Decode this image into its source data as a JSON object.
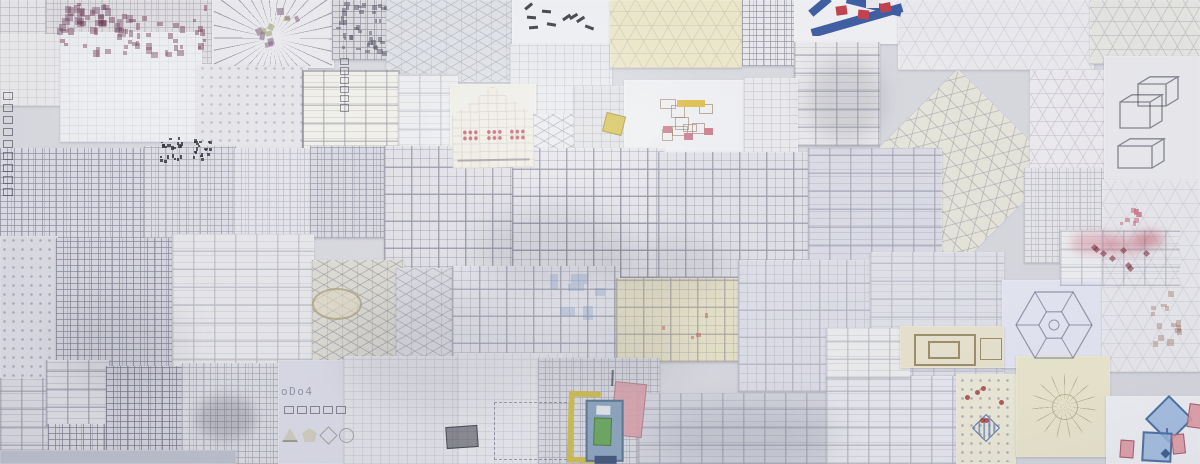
{
  "scene": {
    "name": "wall-of-architectural-pattern-drawings",
    "width": 1200,
    "height": 464
  },
  "text": {
    "odo": "oDo4"
  },
  "palette": {
    "paper_white": "#eff0f3",
    "paper_lavender": "#d8d9e4",
    "paper_cream": "#ece7c6",
    "pencil": "#55556a",
    "model_blue": "#31519c",
    "model_red": "#bf3540",
    "accent_pink": "#c97486",
    "accent_yellow": "#d4bf4a",
    "accent_green": "#69a55e",
    "accent_blue": "#8aa3bd"
  },
  "sheets": [
    {
      "x": 0,
      "y": 0,
      "w": 48,
      "h": 96,
      "bg": "#e7e6e8",
      "p": "grid",
      "po": 0.35
    },
    {
      "x": 46,
      "y": 0,
      "w": 168,
      "h": 70,
      "bg": "#e0dee1",
      "p": "maze",
      "po": 0.3
    },
    {
      "x": 212,
      "y": 0,
      "w": 122,
      "h": 68,
      "bg": "#ebeaee",
      "p": "blank",
      "po": 0
    },
    {
      "x": 332,
      "y": 0,
      "w": 58,
      "h": 60,
      "bg": "#dbdade",
      "p": "maze",
      "po": 0.55
    },
    {
      "x": 386,
      "y": 0,
      "w": 128,
      "h": 82,
      "bg": "#dde0e4",
      "p": "iso",
      "po": 0.35
    },
    {
      "x": 512,
      "y": 0,
      "w": 98,
      "h": 46,
      "bg": "#eef0f4",
      "p": "blank",
      "po": 0
    },
    {
      "x": 510,
      "y": 44,
      "w": 102,
      "h": 74,
      "bg": "#e8eaee",
      "p": "grid",
      "po": 0.22
    },
    {
      "x": 610,
      "y": 0,
      "w": 132,
      "h": 68,
      "bg": "#ece7c6",
      "p": "hex",
      "po": 0.25
    },
    {
      "x": 742,
      "y": 0,
      "w": 54,
      "h": 66,
      "bg": "#e9e8ec",
      "p": "maze",
      "po": 0.6
    },
    {
      "x": 794,
      "y": 0,
      "w": 124,
      "h": 44,
      "bg": "#f0f1f4",
      "p": "blank",
      "po": 0
    },
    {
      "x": 794,
      "y": 42,
      "w": 86,
      "h": 104,
      "bg": "#eaeaed",
      "p": "rooms",
      "po": 0.5
    },
    {
      "x": 898,
      "y": 0,
      "w": 196,
      "h": 70,
      "bg": "#ebebef",
      "p": "hex",
      "po": 0.22
    },
    {
      "x": 1090,
      "y": 0,
      "w": 110,
      "h": 64,
      "bg": "#e7e7e3",
      "p": "hex",
      "po": 0.35
    },
    {
      "x": 0,
      "y": 34,
      "w": 62,
      "h": 72,
      "bg": "#eae9eb",
      "p": "grid",
      "po": 0.2
    },
    {
      "x": 60,
      "y": 32,
      "w": 142,
      "h": 110,
      "bg": "#edeff2",
      "p": "grid",
      "po": 0.15
    },
    {
      "x": 198,
      "y": 64,
      "w": 110,
      "h": 100,
      "bg": "#e6e5e9",
      "p": "dots",
      "po": 0.4
    },
    {
      "x": 302,
      "y": 70,
      "w": 98,
      "h": 90,
      "bg": "#f1f0ea",
      "p": "rooms",
      "po": 0.5,
      "bd": 1
    },
    {
      "x": 398,
      "y": 74,
      "w": 60,
      "h": 92,
      "bg": "#ebedf0",
      "p": "rooms",
      "po": 0.3
    },
    {
      "x": 450,
      "y": 84,
      "w": 86,
      "h": 84,
      "bg": "#eeede6",
      "p": "blank",
      "po": 0
    },
    {
      "x": 518,
      "y": 114,
      "w": 66,
      "h": 54,
      "bg": "#e9eaed",
      "p": "iso",
      "po": 0.5
    },
    {
      "x": 574,
      "y": 86,
      "w": 54,
      "h": 80,
      "bg": "#e0e2e5",
      "p": "grid",
      "po": 0.3
    },
    {
      "x": 624,
      "y": 80,
      "w": 124,
      "h": 82,
      "bg": "#eeeff2",
      "p": "blank",
      "po": 0
    },
    {
      "x": 744,
      "y": 78,
      "w": 54,
      "h": 86,
      "bg": "#e9e9ec",
      "p": "grid",
      "po": 0.25
    },
    {
      "x": 888,
      "y": 98,
      "w": 140,
      "h": 140,
      "bg": "#e6e5da",
      "p": "hex",
      "po": 0.5,
      "rot": 45
    },
    {
      "x": 1030,
      "y": 70,
      "w": 90,
      "h": 108,
      "bg": "#edebef",
      "p": "hex",
      "po": 0.3
    },
    {
      "x": 1024,
      "y": 168,
      "w": 84,
      "h": 95,
      "bg": "#e6e6ea",
      "p": "maze",
      "po": 0.3
    },
    {
      "x": 1104,
      "y": 56,
      "w": 96,
      "h": 126,
      "bg": "#eaeaee",
      "p": "blank",
      "po": 0
    },
    {
      "x": 0,
      "y": 148,
      "w": 146,
      "h": 90,
      "bg": "#dadae4",
      "p": "maze",
      "po": 0.6
    },
    {
      "x": 144,
      "y": 146,
      "w": 92,
      "h": 92,
      "bg": "#dedee6",
      "p": "maze",
      "po": 0.45
    },
    {
      "x": 234,
      "y": 148,
      "w": 78,
      "h": 90,
      "bg": "#e4e4ea",
      "p": "maze",
      "po": 0.3
    },
    {
      "x": 310,
      "y": 146,
      "w": 92,
      "h": 92,
      "bg": "#d8d8e2",
      "p": "maze",
      "po": 0.5
    },
    {
      "x": 384,
      "y": 146,
      "w": 134,
      "h": 130,
      "bg": "#e0e0e6",
      "p": "tiles",
      "po": 0.55
    },
    {
      "x": 512,
      "y": 148,
      "w": 152,
      "h": 130,
      "bg": "#e4e4ea",
      "p": "tiles",
      "po": 0.6
    },
    {
      "x": 658,
      "y": 152,
      "w": 154,
      "h": 126,
      "bg": "#dfdfe7",
      "p": "tiles",
      "po": 0.5
    },
    {
      "x": 808,
      "y": 148,
      "w": 134,
      "h": 134,
      "bg": "#d9dae5",
      "p": "rooms",
      "po": 0.45
    },
    {
      "x": 1060,
      "y": 230,
      "w": 122,
      "h": 58,
      "bg": "#eff0f2",
      "p": "blank",
      "po": 0
    },
    {
      "x": 1158,
      "y": 182,
      "w": 42,
      "h": 130,
      "bg": "#e6e6eb",
      "p": "grid",
      "po": 0.3
    },
    {
      "x": 0,
      "y": 236,
      "w": 58,
      "h": 148,
      "bg": "#dadae3",
      "p": "dots",
      "po": 0.5
    },
    {
      "x": 56,
      "y": 238,
      "w": 120,
      "h": 154,
      "bg": "#d5d6df",
      "p": "maze",
      "po": 0.65
    },
    {
      "x": 172,
      "y": 234,
      "w": 142,
      "h": 162,
      "bg": "#e7e7eb",
      "p": "rooms",
      "po": 0.35
    },
    {
      "x": 312,
      "y": 260,
      "w": 92,
      "h": 112,
      "bg": "#dcdad2",
      "p": "iso",
      "po": 0.5
    },
    {
      "x": 396,
      "y": 268,
      "w": 100,
      "h": 104,
      "bg": "#dbdce1",
      "p": "iso",
      "po": 0.45
    },
    {
      "x": 452,
      "y": 266,
      "w": 168,
      "h": 132,
      "bg": "#e3e4eb",
      "p": "tiles",
      "po": 0.45
    },
    {
      "x": 616,
      "y": 278,
      "w": 124,
      "h": 84,
      "bg": "#e5e1c6",
      "p": "tiles",
      "po": 0.4
    },
    {
      "x": 738,
      "y": 260,
      "w": 138,
      "h": 132,
      "bg": "#dddee7",
      "p": "tiles",
      "po": 0.3
    },
    {
      "x": 870,
      "y": 252,
      "w": 134,
      "h": 138,
      "bg": "#e0e1e9",
      "p": "rooms",
      "po": 0.3
    },
    {
      "x": 1002,
      "y": 280,
      "w": 104,
      "h": 88,
      "bg": "#e4e6f3",
      "p": "blank",
      "po": 0
    },
    {
      "x": 1102,
      "y": 180,
      "w": 98,
      "h": 192,
      "bg": "#e9e9ed",
      "p": "hex",
      "po": 0.2
    },
    {
      "x": 0,
      "y": 378,
      "w": 54,
      "h": 86,
      "bg": "#d9d9e1",
      "p": "rooms",
      "po": 0.5
    },
    {
      "x": 46,
      "y": 360,
      "w": 64,
      "h": 66,
      "bg": "#dddde3",
      "p": "rooms",
      "po": 0.55
    },
    {
      "x": 48,
      "y": 424,
      "w": 64,
      "h": 40,
      "bg": "#d7d7df",
      "p": "maze",
      "po": 0.7
    },
    {
      "x": 106,
      "y": 366,
      "w": 80,
      "h": 98,
      "bg": "#d0d1db",
      "p": "maze",
      "po": 0.75
    },
    {
      "x": 182,
      "y": 363,
      "w": 102,
      "h": 101,
      "bg": "#dbdce3",
      "p": "maze",
      "po": 0.4
    },
    {
      "x": 278,
      "y": 360,
      "w": 70,
      "h": 104,
      "bg": "#d9dae5",
      "p": "blank",
      "po": 0
    },
    {
      "x": 344,
      "y": 356,
      "w": 120,
      "h": 108,
      "bg": "#e1e2e7",
      "p": "grid",
      "po": 0.2
    },
    {
      "x": 458,
      "y": 353,
      "w": 114,
      "h": 111,
      "bg": "#e6e7eb",
      "p": "grid",
      "po": 0.18
    },
    {
      "x": 538,
      "y": 358,
      "w": 122,
      "h": 106,
      "bg": "#d9d9e1",
      "p": "maze",
      "po": 0.35
    },
    {
      "x": 638,
      "y": 393,
      "w": 194,
      "h": 71,
      "bg": "#d4d5de",
      "p": "rooms",
      "po": 0.4
    },
    {
      "x": 826,
      "y": 376,
      "w": 136,
      "h": 88,
      "bg": "#e8e9ef",
      "p": "rooms",
      "po": 0.4
    },
    {
      "x": 826,
      "y": 328,
      "w": 84,
      "h": 50,
      "bg": "#edeeee",
      "p": "rooms",
      "po": 0.35
    },
    {
      "x": 900,
      "y": 326,
      "w": 104,
      "h": 42,
      "bg": "#e9e3cd",
      "p": "blank",
      "po": 0
    },
    {
      "x": 956,
      "y": 374,
      "w": 60,
      "h": 90,
      "bg": "#edead8",
      "p": "blank",
      "po": 0
    },
    {
      "x": 1016,
      "y": 356,
      "w": 94,
      "h": 101,
      "bg": "#ebe7cd",
      "p": "blank",
      "po": 0
    },
    {
      "x": 1106,
      "y": 396,
      "w": 94,
      "h": 68,
      "bg": "#eff1f5",
      "p": "blank",
      "po": 0
    },
    {
      "x": 0,
      "y": 450,
      "w": 236,
      "h": 14,
      "bg": "#bcbfcb",
      "p": "blank",
      "po": 0
    }
  ],
  "accents": [
    {
      "t": "cluster",
      "x": 50,
      "y": 2,
      "w": 160,
      "h": 56,
      "n": 55,
      "s": 5,
      "c": "rgba(112,52,76,0.5)",
      "seed": 7
    },
    {
      "t": "cluster",
      "x": 56,
      "y": 4,
      "w": 78,
      "h": 34,
      "n": 25,
      "s": 7,
      "c": "rgba(96,42,72,0.4)",
      "seed": 11
    },
    {
      "t": "cluster",
      "x": 336,
      "y": 2,
      "w": 52,
      "h": 54,
      "n": 40,
      "s": 4,
      "c": "rgba(66,66,82,0.5)",
      "seed": 3
    },
    {
      "t": "burst",
      "x": 214,
      "y": 0,
      "w": 118,
      "h": 66,
      "c": "rgba(72,72,88,0.5)",
      "bg": "#ecebef"
    },
    {
      "t": "cluster",
      "x": 246,
      "y": 8,
      "w": 54,
      "h": 40,
      "n": 7,
      "s": 6,
      "c": "rgba(118,88,118,0.55)",
      "seed": 5,
      "rot": 30
    },
    {
      "t": "cluster",
      "x": 258,
      "y": 14,
      "w": 34,
      "h": 24,
      "n": 4,
      "s": 5,
      "c": "rgba(148,148,88,0.55)",
      "seed": 9,
      "rot": 30
    },
    {
      "t": "cluster",
      "x": 520,
      "y": 4,
      "w": 84,
      "h": 36,
      "n": 9,
      "s": 9,
      "c": "rgba(25,25,32,0.85)",
      "seed": 13,
      "rot": 40,
      "bar": 2.5
    },
    {
      "t": "model",
      "x": 806,
      "y": 0,
      "w": 110,
      "h": 36,
      "blue": "#31519c",
      "red": "#bf3540",
      "white": "#e9eaee"
    },
    {
      "t": "blob",
      "x": 806,
      "y": 58,
      "w": 78,
      "h": 84,
      "c": "rgba(58,58,76,0.16)",
      "blur": 10
    },
    {
      "t": "house",
      "x": 452,
      "y": 86,
      "w": 82,
      "h": 82,
      "bg": "#efece2",
      "dot": "#c25668",
      "line": "rgba(90,90,108,0.5)"
    },
    {
      "t": "rect",
      "x": 604,
      "y": 114,
      "w": 18,
      "h": 18,
      "c": "#d4bf4a",
      "bd": "rgba(120,100,40,0.5)",
      "rot": 14
    },
    {
      "t": "pav",
      "x": 650,
      "y": 90,
      "w": 84,
      "h": 62,
      "ink": "rgba(135,95,70,0.55)",
      "bar": "#dcb93e",
      "pk": "#c97486",
      "seed": 17
    },
    {
      "t": "cluster",
      "x": 158,
      "y": 136,
      "w": 26,
      "h": 28,
      "n": 22,
      "s": 3,
      "c": "rgba(25,25,35,0.8)",
      "seed": 21
    },
    {
      "t": "cluster",
      "x": 192,
      "y": 138,
      "w": 22,
      "h": 26,
      "n": 18,
      "s": 3,
      "c": "rgba(25,25,35,0.75)",
      "seed": 22
    },
    {
      "t": "strip",
      "x": 3,
      "y": 92,
      "n": 9,
      "s": 8,
      "gap": 6,
      "dir": "v",
      "c": "rgba(40,40,58,0.55)"
    },
    {
      "t": "strip",
      "x": 340,
      "y": 58,
      "n": 6,
      "s": 7,
      "gap": 4,
      "dir": "v",
      "c": "rgba(40,40,58,0.5)"
    },
    {
      "t": "strip",
      "x": 284,
      "y": 406,
      "n": 5,
      "s": 8,
      "gap": 5,
      "dir": "h",
      "c": "rgba(40,40,58,0.5)"
    },
    {
      "t": "text",
      "x": 281,
      "y": 385,
      "bind": "text.odo",
      "c": "rgba(70,70,100,0.55)"
    },
    {
      "t": "shapesrow",
      "x": 282,
      "y": 424,
      "c": "rgba(205,202,186,0.95)",
      "bd": "rgba(120,120,110,0.6)"
    },
    {
      "t": "ell",
      "x": 312,
      "y": 288,
      "w": 46,
      "h": 28,
      "c": "rgba(150,140,105,0.6)",
      "bg": "rgba(226,218,192,0.55)"
    },
    {
      "t": "wc",
      "x": 1060,
      "y": 230,
      "w": 120,
      "h": 56,
      "pink": "rgba(213,125,142,0.45)",
      "red": "rgba(190,70,85,0.5)",
      "dia": "rgba(120,40,55,0.6)",
      "seed": 25
    },
    {
      "t": "hex",
      "x": 1006,
      "y": 284,
      "w": 96,
      "h": 82,
      "c": "rgba(75,75,105,0.55)"
    },
    {
      "t": "iso3",
      "x": 1112,
      "y": 76,
      "w": 82,
      "h": 106,
      "c": "rgba(55,55,70,0.6)"
    },
    {
      "t": "cluster",
      "x": 1118,
      "y": 208,
      "w": 26,
      "h": 18,
      "n": 10,
      "s": 4,
      "c": "rgba(200,110,130,0.6)",
      "seed": 31
    },
    {
      "t": "cluster",
      "x": 1148,
      "y": 290,
      "w": 38,
      "h": 62,
      "n": 14,
      "s": 5,
      "c": "rgba(150,100,80,0.35)",
      "seed": 33
    },
    {
      "t": "cluster",
      "x": 548,
      "y": 272,
      "w": 60,
      "h": 50,
      "n": 6,
      "s": 12,
      "c": "rgba(120,150,200,0.3)",
      "seed": 43
    },
    {
      "t": "cluster",
      "x": 660,
      "y": 300,
      "w": 60,
      "h": 40,
      "n": 4,
      "s": 4,
      "c": "rgba(190,80,90,0.5)",
      "seed": 45
    },
    {
      "t": "dash",
      "x": 494,
      "y": 402,
      "w": 76,
      "h": 56,
      "c": "rgba(80,80,105,0.5)"
    },
    {
      "t": "blob",
      "x": 196,
      "y": 396,
      "w": 60,
      "h": 44,
      "c": "rgba(50,50,65,0.22)",
      "blur": 6
    },
    {
      "t": "rect",
      "x": 446,
      "y": 426,
      "w": 30,
      "h": 20,
      "c": "rgba(40,40,52,0.5)",
      "bd": "rgba(30,30,40,0.6)",
      "rot": -4
    },
    {
      "t": "axon",
      "x": 566,
      "y": 376,
      "w": 90,
      "h": 88,
      "yellow": "#cdbb4e",
      "blue": "#8aa3bd",
      "bluebd": "#5a7390",
      "green": "#69a55e",
      "pink": "rgba(216,160,170,0.9)",
      "pinkbd": "#b2808a",
      "navy": "#41537a"
    },
    {
      "t": "nested",
      "x": 906,
      "y": 330,
      "w": 96,
      "h": 36,
      "c": "rgba(120,100,55,0.7)"
    },
    {
      "t": "bingo",
      "x": 958,
      "y": 376,
      "w": 56,
      "h": 86,
      "blue": "rgba(95,130,185,0.75)",
      "red": "rgba(165,45,50,0.8)",
      "ink": "rgba(90,90,110,0.6)",
      "seed": 27
    },
    {
      "t": "radial",
      "x": 1020,
      "y": 360,
      "w": 88,
      "h": 92,
      "c": "rgba(130,120,80,0.45)"
    },
    {
      "t": "shapes",
      "x": 1108,
      "y": 398,
      "blueFill": "rgba(152,182,222,0.85)",
      "blueBd": "#4a6fa0",
      "pinkFill": "rgba(224,152,162,0.9)",
      "pinkBd": "#a45868",
      "navy": "#3c5a8c"
    },
    {
      "t": "blob",
      "x": 478,
      "y": 208,
      "w": 150,
      "h": 82,
      "c": "rgba(70,70,90,0.13)",
      "blur": 14
    },
    {
      "t": "blob",
      "x": 598,
      "y": 236,
      "w": 132,
      "h": 62,
      "c": "rgba(70,70,90,0.11)",
      "blur": 14
    },
    {
      "t": "blob",
      "x": 338,
      "y": 288,
      "w": 224,
      "h": 122,
      "c": "rgba(88,88,108,0.10)",
      "blur": 20
    },
    {
      "t": "blob",
      "x": 560,
      "y": 300,
      "w": 122,
      "h": 92,
      "c": "rgba(88,88,108,0.10)",
      "blur": 18
    },
    {
      "t": "blob",
      "x": 648,
      "y": 406,
      "w": 192,
      "h": 58,
      "c": "rgba(75,80,105,0.12)",
      "blur": 14
    },
    {
      "t": "blob",
      "x": 58,
      "y": 298,
      "w": 122,
      "h": 92,
      "c": "rgba(80,80,100,0.10)",
      "blur": 18
    },
    {
      "t": "blob",
      "x": 430,
      "y": 58,
      "w": 262,
      "h": 122,
      "c": "rgba(255,255,255,0.16)",
      "blur": 24
    },
    {
      "t": "blob",
      "x": 58,
      "y": 38,
      "w": 152,
      "h": 92,
      "c": "rgba(255,255,255,0.2)",
      "blur": 20
    }
  ]
}
